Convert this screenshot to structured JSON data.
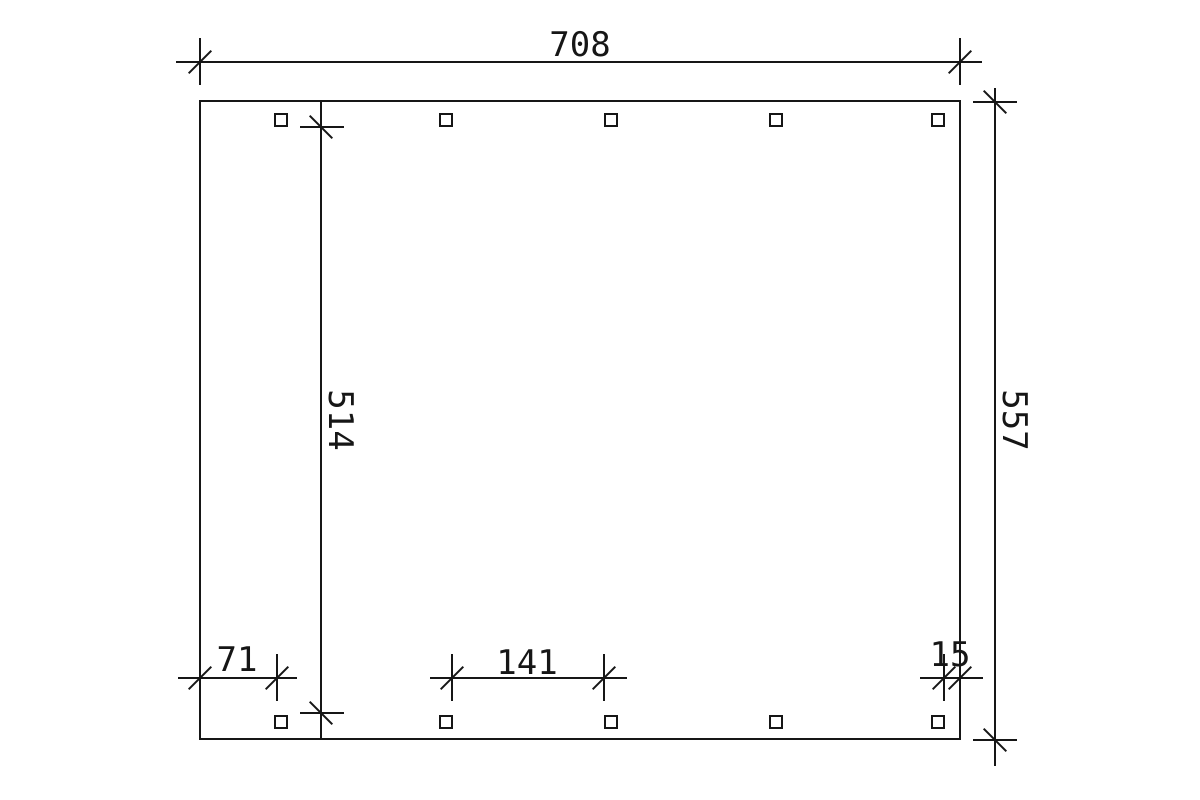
{
  "page": {
    "background": "#ffffff",
    "line_color": "#161616",
    "description": "CAD-style technical ground plan of a rectangular carport with two rows of five square post markers and dimension lines"
  },
  "drawing": {
    "dimensions": {
      "total_width": "708",
      "total_depth": "557",
      "inner_depth": "514",
      "left_post_offset": "71",
      "post_clear_spacing": "141",
      "right_post_offset": "15"
    },
    "posts": {
      "column_x": [
        274,
        439,
        604,
        769,
        931
      ],
      "top_row_y": 113,
      "bottom_row_y": 715,
      "size": 14
    }
  }
}
